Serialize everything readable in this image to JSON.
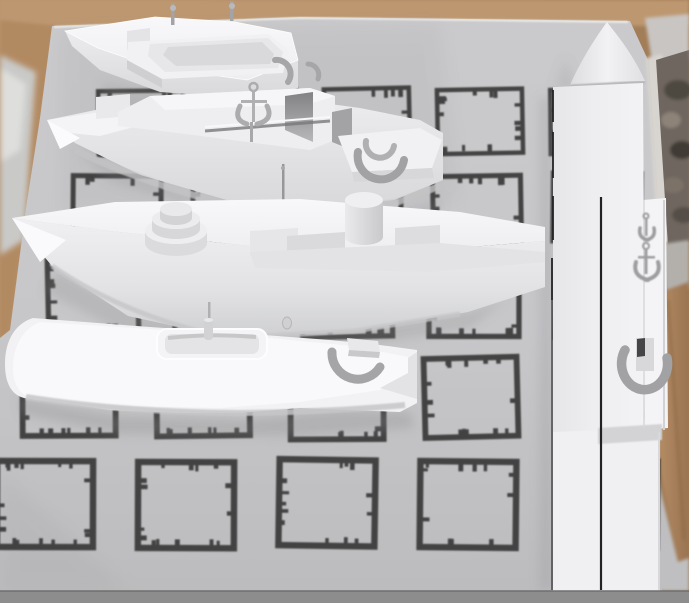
{
  "scene": {
    "description": "Four white 3D ship models and one overhead-view ship model rendered over a camera image of a printed fiducial-marker sheet lying on a wooden table",
    "colors": {
      "wood": "#b9946e",
      "wood_dark": "#9f7a54",
      "paper": "#c7c7c9",
      "paper_dark": "#b2b2b4",
      "marker": "#343436",
      "model_bright": "#f8f8fa",
      "model_light": "#efeff1",
      "model_mid": "#dfdfe1",
      "model_dark": "#c8c8ca",
      "detail_gray": "#a4a4a6",
      "line_dark": "#222224",
      "shadow": "#88888a",
      "bar": "#8d8d8d",
      "blur_object": "#c9c9c7",
      "dark_texture": "#6e665e"
    },
    "marker_grid": {
      "rows": 5,
      "columns": 5,
      "style": "inked square outlines with tick marks"
    },
    "models": [
      {
        "id": "ship-1",
        "label": "Small patrol boat model (top)"
      },
      {
        "id": "ship-2",
        "label": "Corvette model with anchor ornament (second)"
      },
      {
        "id": "ship-3",
        "label": "Destroyer model with gun turret and funnel (third)"
      },
      {
        "id": "ship-4",
        "label": "Flat-deck vessel model seen from above (bottom)"
      },
      {
        "id": "ship-5",
        "label": "Large ship model in overhead view (right)"
      }
    ]
  }
}
